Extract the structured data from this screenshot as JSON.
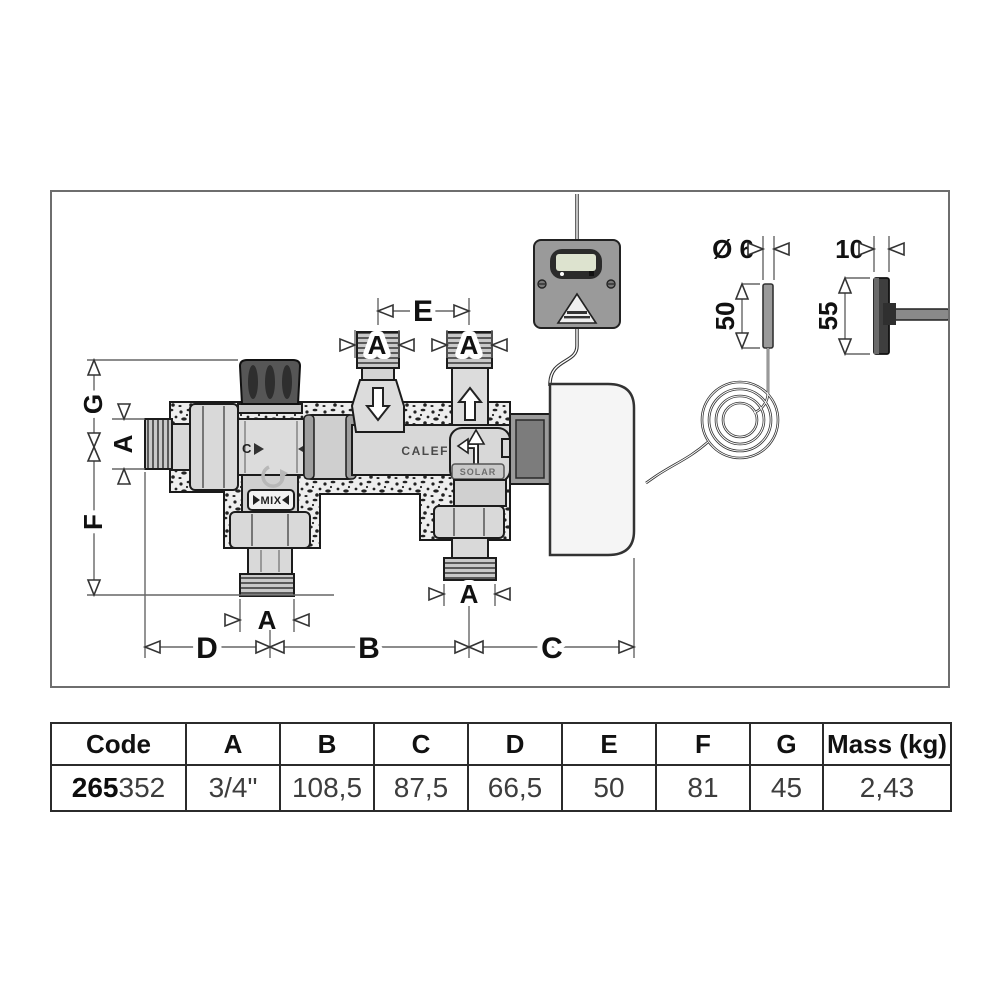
{
  "diagram": {
    "dim_labels": {
      "A": "A",
      "B": "B",
      "C": "C",
      "D": "D",
      "E": "E",
      "F": "F",
      "G": "G"
    },
    "port_markers": {
      "cold": "C",
      "hot": "H"
    },
    "component_text": {
      "brand": "CALEFFI",
      "solar": "SOLAR",
      "mix": "MIX"
    },
    "sensor_detail": {
      "diameter": "Ø 6",
      "length": "50"
    },
    "handle_detail": {
      "width": "10",
      "length": "55"
    }
  },
  "table": {
    "headers": [
      "Code",
      "A",
      "B",
      "C",
      "D",
      "E",
      "F",
      "G",
      "Mass (kg)"
    ],
    "row": {
      "code_bold": "265",
      "code_rest": "352",
      "values": [
        "3/4\"",
        "108,5",
        "87,5",
        "66,5",
        "50",
        "81",
        "45",
        "2,43"
      ]
    }
  }
}
